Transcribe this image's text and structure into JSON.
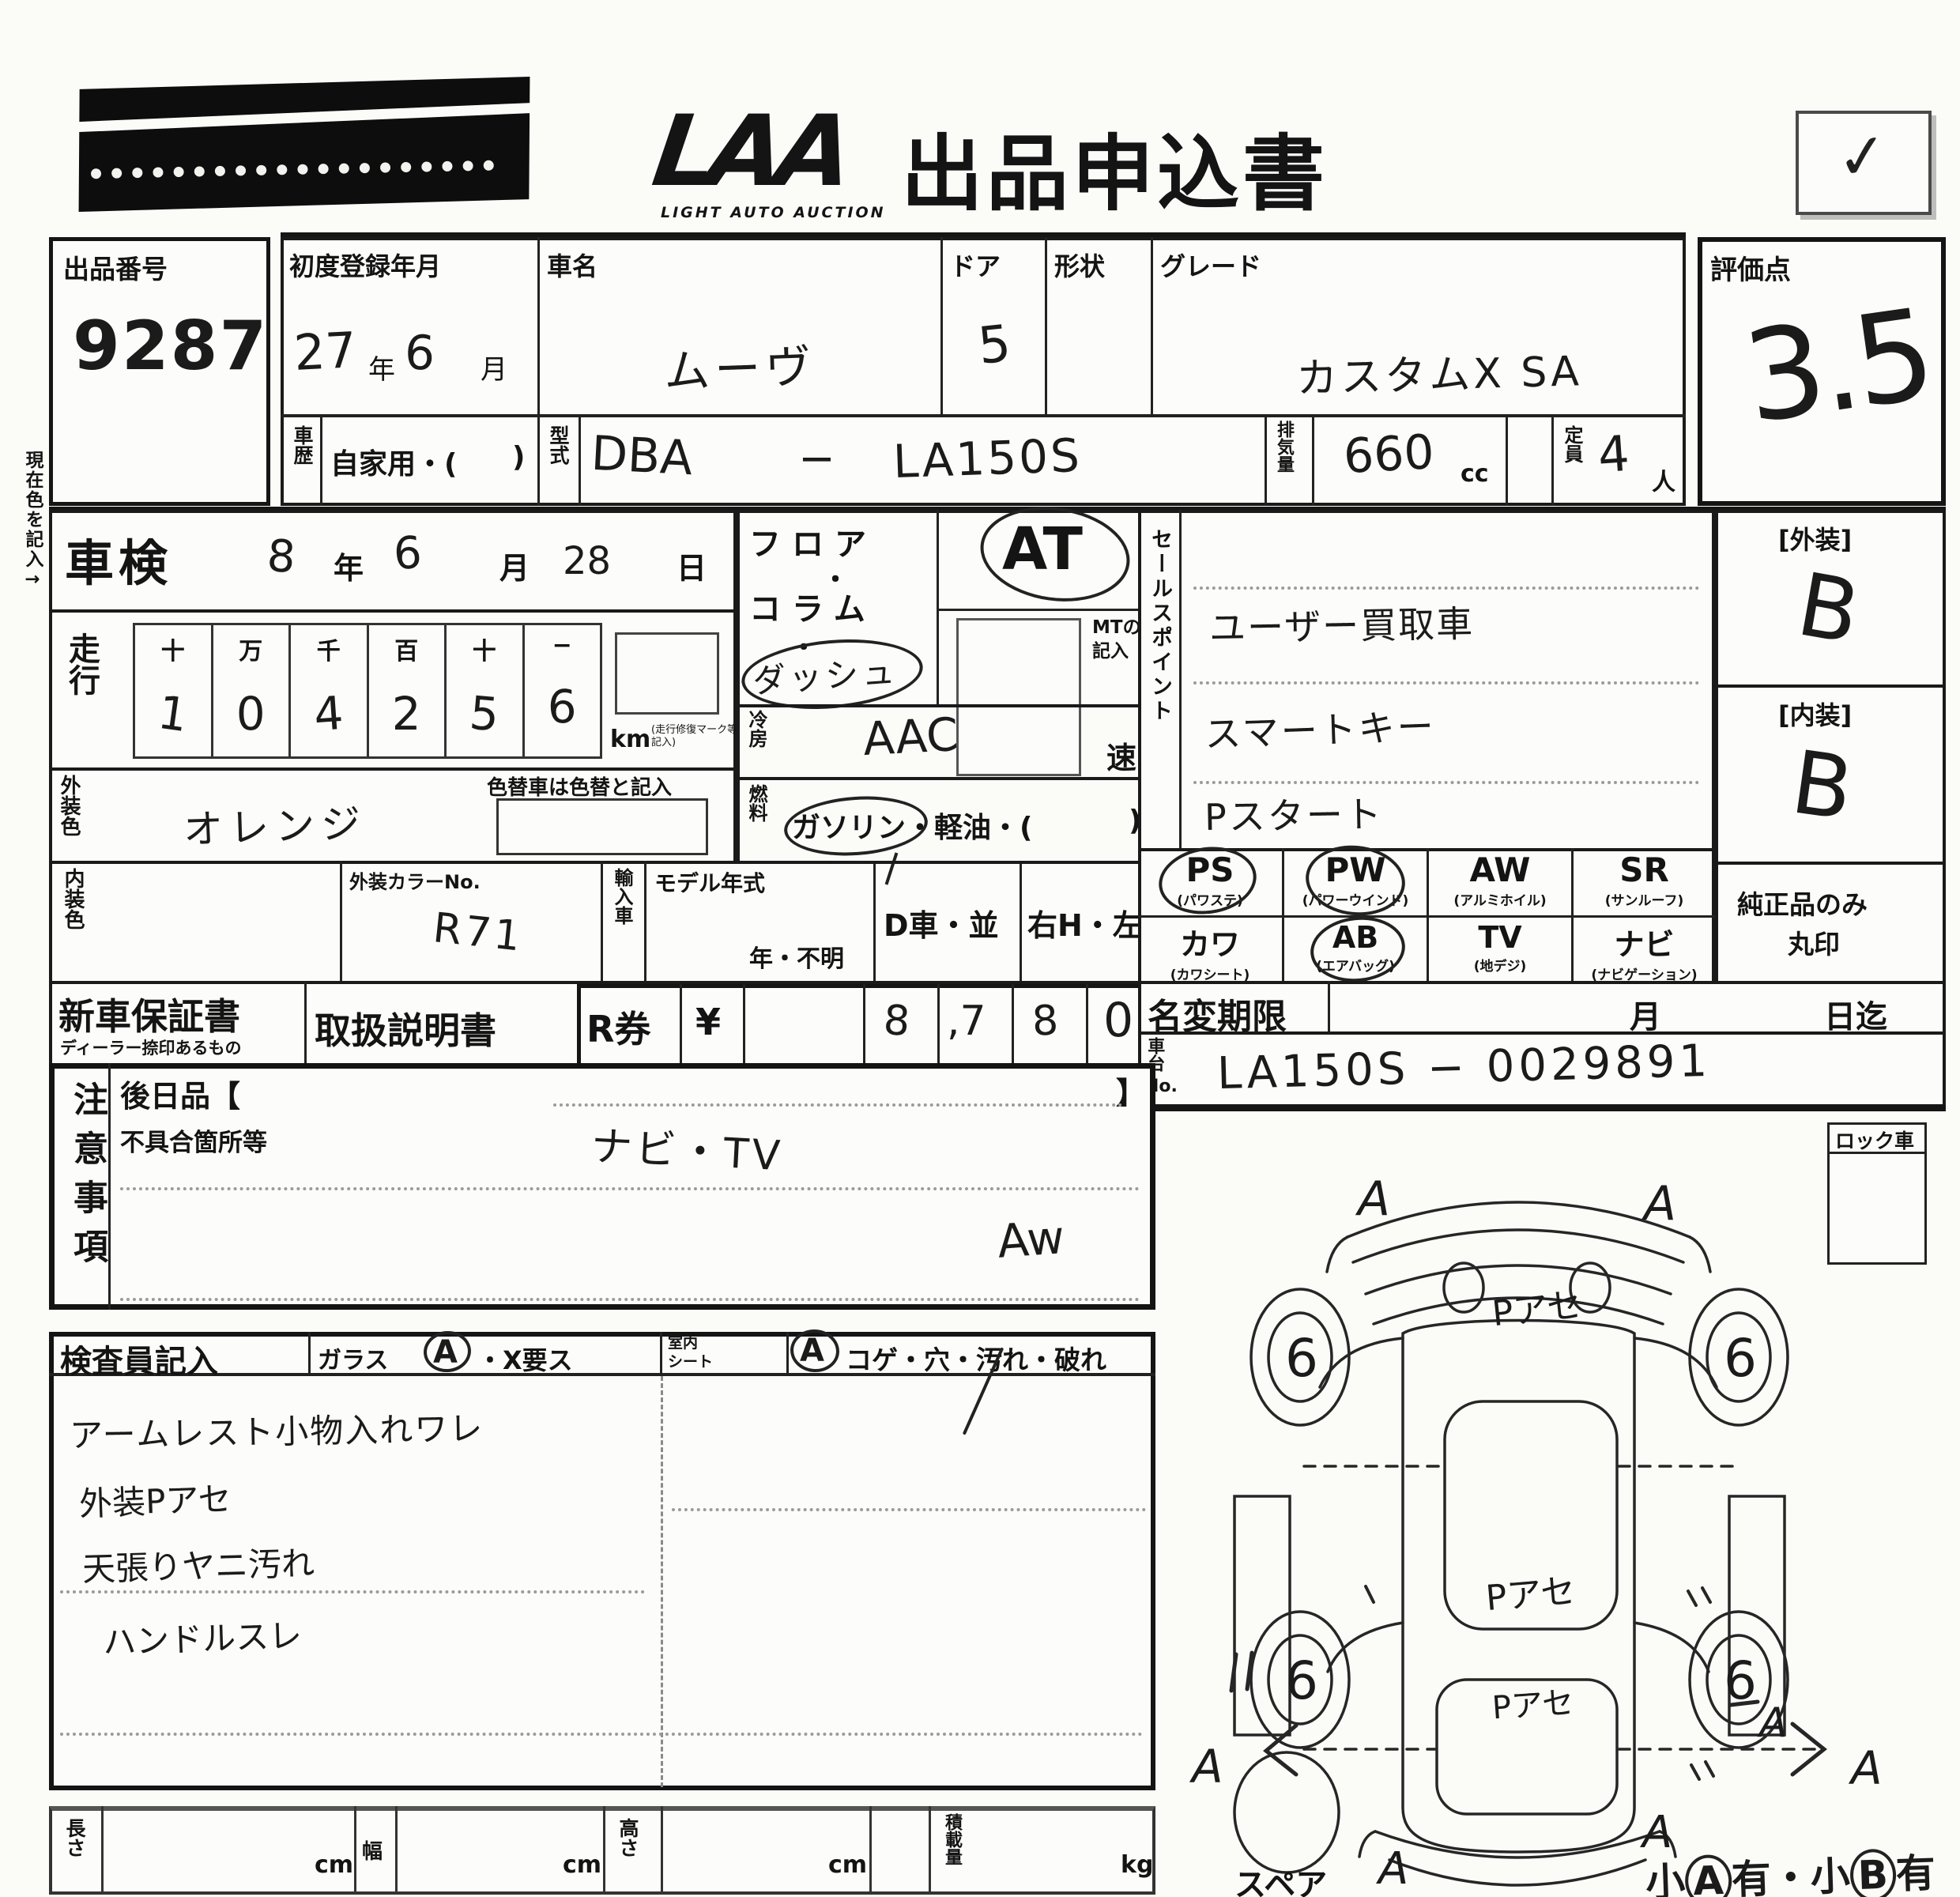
{
  "header": {
    "logo": "LAA",
    "logo_sub": "LIGHT AUTO AUCTION",
    "title": "出品申込書",
    "check_mark": "✓"
  },
  "lot": {
    "label": "出品番号",
    "value": "9287"
  },
  "first_reg": {
    "label": "初度登録年月",
    "year": "27",
    "year_unit": "年",
    "month": "6",
    "month_unit": "月"
  },
  "car_name": {
    "label": "車名",
    "value": "ムーヴ"
  },
  "doors": {
    "label": "ドア",
    "value": "5"
  },
  "shape": {
    "label": "形状"
  },
  "grade": {
    "label": "グレード",
    "value": "カスタムX SA"
  },
  "history": {
    "label": "車歴",
    "value": "自家用・(",
    "paren": ")"
  },
  "model_code": {
    "label": "型式",
    "value_left": "DBA",
    "dash": "−",
    "value_right": "LA150S"
  },
  "displacement": {
    "label": "排気量",
    "value": "660",
    "unit": "cc"
  },
  "capacity": {
    "label": "定員",
    "value": "4",
    "unit": "人"
  },
  "score": {
    "label": "評価点",
    "value": "3.5"
  },
  "shaken": {
    "label": "車検",
    "year": "8",
    "year_unit": "年",
    "month": "6",
    "month_unit": "月",
    "day": "28",
    "day_unit": "日"
  },
  "mileage": {
    "label": "走行",
    "headers": [
      "十",
      "万",
      "千",
      "百",
      "十",
      "−"
    ],
    "digits": [
      "1",
      "0",
      "4",
      "2",
      "5",
      "6"
    ],
    "unit": "km",
    "unit_note": "走行修復マーク等記入",
    "color_change_note": "色替車は色替と記入"
  },
  "margin_note": "現在色を記入→",
  "exterior_color": {
    "label": "外装色",
    "value": "オレンジ"
  },
  "interior_color": {
    "label": "内装色"
  },
  "color_no": {
    "label": "外装カラーNo.",
    "value": "R71"
  },
  "import_car": {
    "label": "輸入車"
  },
  "model_year": {
    "label": "モデル年式",
    "value": "年・不明"
  },
  "d_car": "D車・並",
  "steering": "右H・左H",
  "shift": {
    "floor": "フロア",
    "sep1": "・",
    "column": "コラム",
    "sep2": "・",
    "dash": "ダッシュ",
    "at": "AT",
    "mt_note_1": "MTのみ",
    "mt_note_2": "記入",
    "speed": "速"
  },
  "ac": {
    "label": "冷房",
    "value": "AAC"
  },
  "fuel": {
    "label": "燃料",
    "value": "ガソリン・軽油・(",
    "paren": ")"
  },
  "sales_points": {
    "label": "セールスポイント",
    "items": [
      "ユーザー買取車",
      "スマートキー",
      "Pスタート"
    ]
  },
  "exterior_grade": {
    "label": "[外装]",
    "value": "B"
  },
  "interior_grade": {
    "label": "[内装]",
    "value": "B"
  },
  "equipment": {
    "row1": [
      {
        "code": "PS",
        "name": "(パワステ)"
      },
      {
        "code": "PW",
        "name": "(パワーウインド)"
      },
      {
        "code": "AW",
        "name": "(アルミホイル)"
      },
      {
        "code": "SR",
        "name": "(サンルーフ)"
      }
    ],
    "row2": [
      {
        "code": "カワ",
        "name": "(カワシート)"
      },
      {
        "code": "AB",
        "name": "(エアバッグ)"
      },
      {
        "code": "TV",
        "name": "(地デジ)"
      },
      {
        "code": "ナビ",
        "name": "(ナビゲーション)"
      }
    ],
    "genuine_line1": "純正品のみ",
    "genuine_line2": "丸印"
  },
  "warranty": {
    "label": "新車保証書",
    "sub": "ディーラー捺印あるもの"
  },
  "manual_label": "取扱説明書",
  "r_ticket": {
    "label": "R券",
    "currency": "¥",
    "digits": [
      "",
      "8",
      ",7",
      "8",
      "0"
    ]
  },
  "name_change": {
    "label": "名変期限",
    "month_unit": "月",
    "day_unit": "日迄"
  },
  "chassis": {
    "label_1": "車台",
    "label_2": "No.",
    "value": "LA150S − 0029891"
  },
  "lock_car": "ロック車",
  "notes": {
    "label": "注意事項",
    "later_label": "後日品【",
    "later_close": "】",
    "defect_label": "不具合箇所等",
    "entry_1": "ナビ・TV",
    "entry_2": "Aw"
  },
  "inspector": {
    "label": "検査員記入",
    "glass_label": "ガラス",
    "glass_mark": "A",
    "glass_rest": "・X要ス",
    "seat_label_1": "室内",
    "seat_label_2": "シート",
    "seat_mark": "A",
    "seat_rest": "コゲ・穴・汚れ・破れ",
    "findings": [
      "アームレスト小物入れワレ",
      "外装Pアセ",
      "天張りヤニ汚れ",
      "ハンドルスレ"
    ]
  },
  "diagram": {
    "wheel_mark": "6",
    "corner_mark": "A",
    "panel_mark_hood": "Pアセ",
    "panel_mark_roof": "Pアセ",
    "panel_mark_rear": "Pアセ",
    "tick_mark": "11",
    "dash_mark": "−A",
    "spare_label": "スペア",
    "note_pre": "小",
    "note_a": "A",
    "note_mid": "有・小",
    "note_b": "B",
    "note_post": "有"
  },
  "dimensions": {
    "length": "長さ",
    "width": "幅",
    "height": "高さ",
    "load": "積載量",
    "cm": "cm",
    "kg": "kg"
  }
}
